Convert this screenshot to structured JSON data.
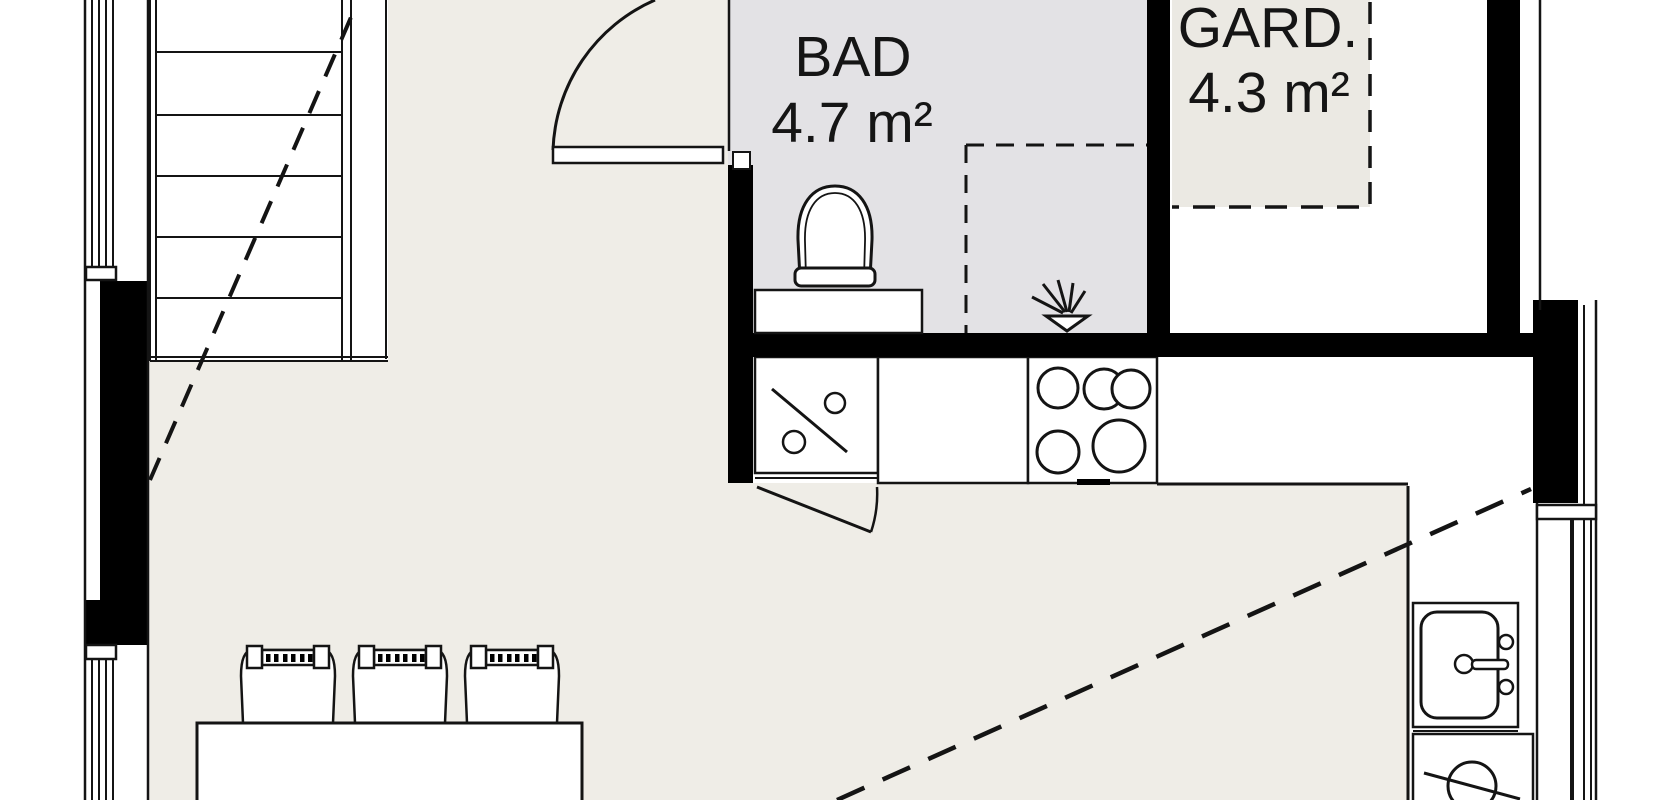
{
  "plan_title": "Attic apartment floor plan (cropped view)",
  "rooms": {
    "bad": {
      "label": "BAD",
      "area": "4.7 m²"
    },
    "gard": {
      "label": "GARD.",
      "area": "4.3 m²"
    },
    "living": {
      "label": "",
      "area": ""
    }
  },
  "fixtures": {
    "staircase-icon": "straight stair run with walk-line dash",
    "entry-door-icon": "door leaf with quarter-circle swing arc",
    "toilet-icon": "toilet bowl against bathroom counter",
    "bathroom-counter-icon": "vanity counter",
    "shower-drain-icon": "floor drain with spray lines",
    "dishwasher-icon": "appliance square with diagonal and two knobs",
    "cabinet-flap-icon": "small door swing under counter",
    "cooktop-icon": "4-burner stove top",
    "kitchen-sink-icon": "single basin sink with faucet",
    "under-counter-appliance-icon": "appliance with circle and diagonal",
    "dining-table-icon": "rectangular table with three chairs",
    "ceiling-height-line": "diagonal dashed line marking sloped ceiling",
    "low-ceiling-zone": "dashed rectangle in wardrobe room",
    "window-icon": "multi-line window glazing in wall"
  },
  "colors": {
    "floor": "#efede7",
    "bathroom_floor": "#e3e2e5",
    "wardrobe_floor": "#ebe9e3",
    "wall": "#000000",
    "line": "#141414",
    "background": "#ffffff"
  }
}
